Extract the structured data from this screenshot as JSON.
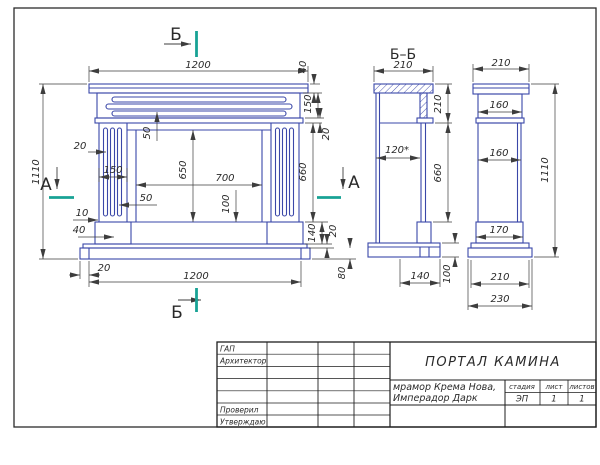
{
  "colors": {
    "outline": "#3a47a8",
    "dim": "#3d3d3d",
    "text": "#2a2a2a",
    "section": "#18a295"
  },
  "drawing": {
    "front": {
      "dim_top_width": "1200",
      "dim_height": "1110",
      "dim_flute_offset": "20",
      "dim_column_width": "150",
      "dim_jamb": "50",
      "dim_flute": "10",
      "dim_plinth_offset": "40",
      "dim_base_inset": "20",
      "dim_bottom_width": "1200",
      "dim_groove": "50",
      "dim_opening_height": "650",
      "dim_opening_width": "700",
      "dim_hearth": "100",
      "dim_shelf_h": "40",
      "dim_frieze_h": "150",
      "dim_band_h": "20",
      "dim_leg_h": "660",
      "dim_plinth_h": "140",
      "dim_base_strip_h": "20",
      "dim_base_h": "80"
    },
    "section": {
      "title": "Б–Б",
      "dim_top": "210",
      "dim_shelf_h": "210",
      "dim_depth": "120*",
      "dim_leg_h": "660",
      "dim_plinth_d": "140",
      "dim_base_h": "100"
    },
    "side": {
      "dim_top": "210",
      "dim_frieze_w": "160",
      "dim_body_w": "160",
      "dim_height": "1110",
      "dim_plinth_w": "170",
      "dim_base_w": "210",
      "dim_base_total": "230"
    },
    "marks": {
      "a_left": "А",
      "a_right": "А",
      "b_top": "Б",
      "b_bottom": "Б"
    }
  },
  "title_block": {
    "rows": [
      "ГАП",
      "Архитектор",
      "",
      "",
      "",
      "Проверил",
      "Утверждаю"
    ],
    "title": "ПОРТАЛ КАМИНА",
    "material_line1": "мрамор Крема Нова,",
    "material_line2": "Имперадор Дарк",
    "stage_label": "стадия",
    "sheet_label": "лист",
    "sheets_label": "листов",
    "stage_value": "ЭП",
    "sheet_value": "1",
    "sheets_value": "1"
  }
}
